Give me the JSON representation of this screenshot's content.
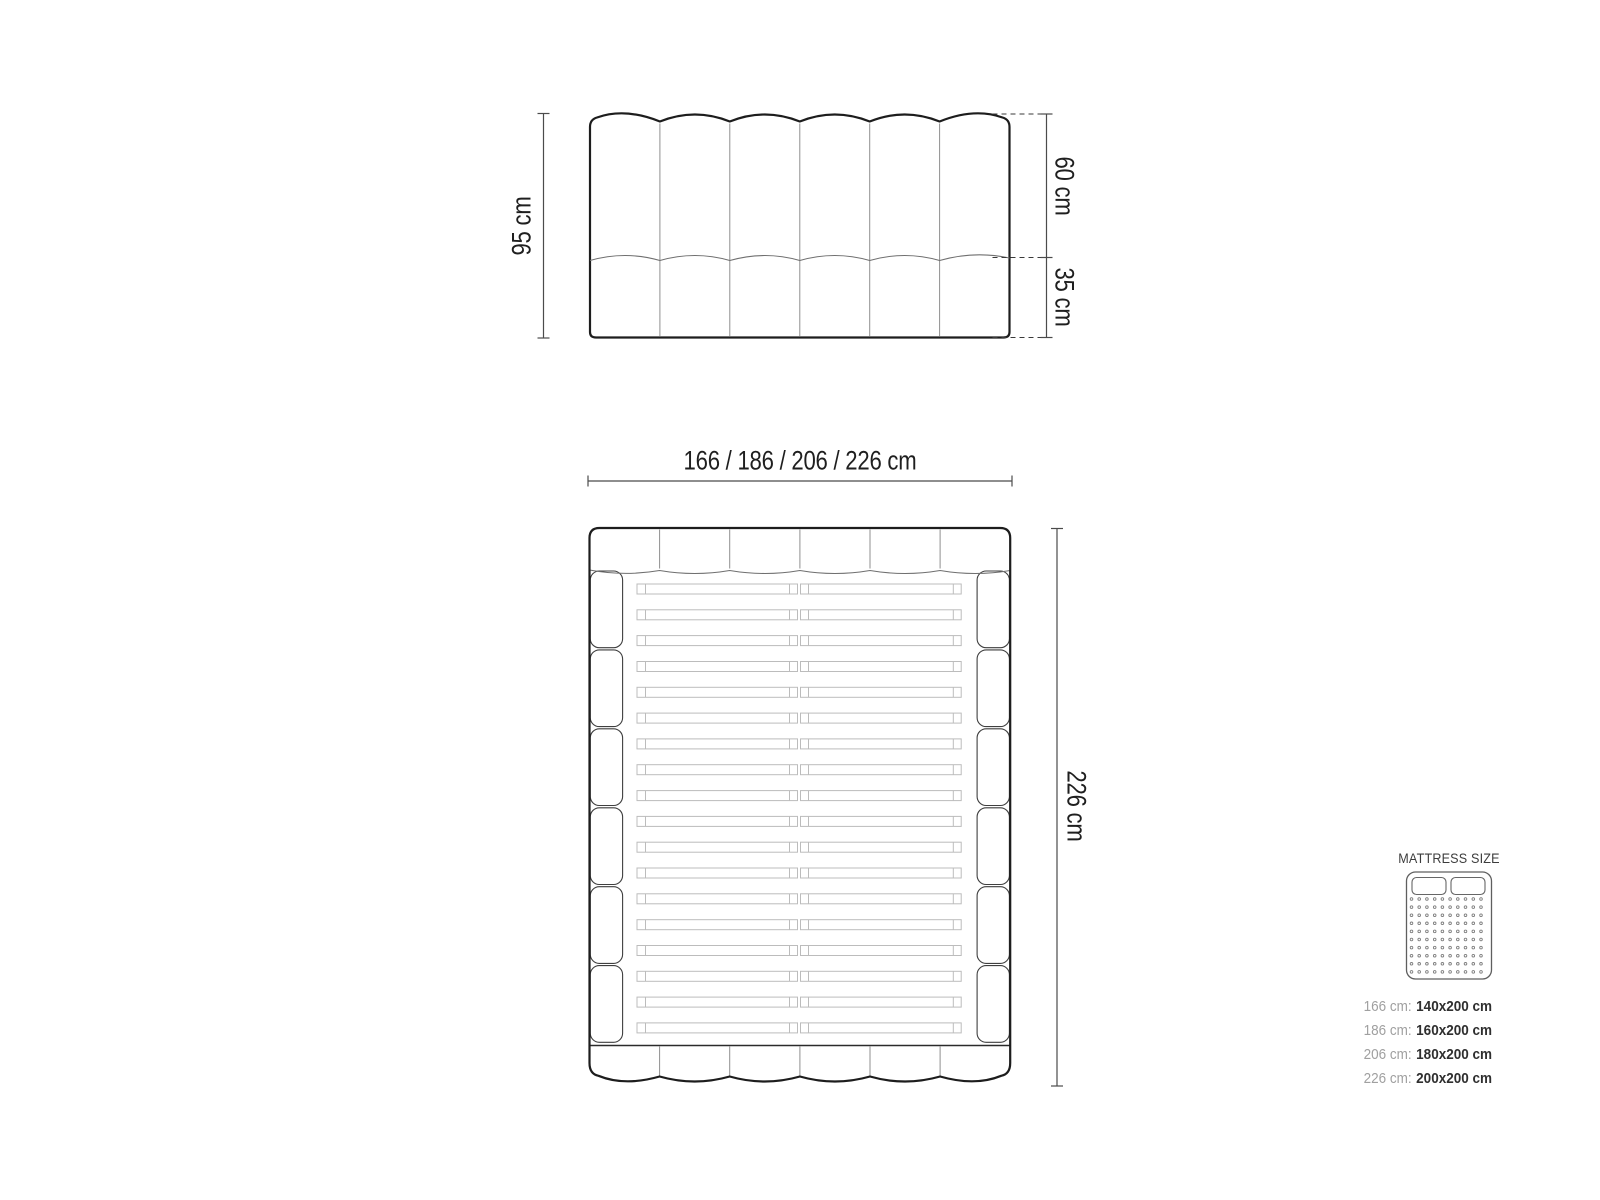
{
  "diagram": {
    "headboard_front": {
      "height_label": "95 cm",
      "upper_height_label": "60 cm",
      "lower_height_label": "35 cm",
      "channels": 6
    },
    "bed_top": {
      "width_label": "166 / 186 / 206 / 226 cm",
      "length_label": "226 cm",
      "slat_rows": 18,
      "headboard_segments": 6,
      "footboard_segments": 6,
      "rail_segments_per_side": 6
    }
  },
  "legend": {
    "title": "MATTRESS SIZE",
    "icon": "mattress-top-view-icon",
    "rows": [
      {
        "label": "166 cm:",
        "value": "140x200 cm"
      },
      {
        "label": "186 cm:",
        "value": "160x200 cm"
      },
      {
        "label": "206 cm:",
        "value": "180x200 cm"
      },
      {
        "label": "226 cm:",
        "value": "200x200 cm"
      }
    ]
  },
  "colors": {
    "background": "#ffffff",
    "outline": "#1d1d1d",
    "thin_line": "#8f8f8f",
    "tuft_line": "#6f6f6f",
    "rail_line": "#3f3f3f",
    "slat_line": "#bcbcbc",
    "dimension_line": "#4b4b4b",
    "dashed_line": "#3a3a3a",
    "label_text": "#1f1f1f",
    "legend_title": "#3c3c3c",
    "legend_label": "#a0a0a0",
    "legend_value": "#2f2f2f",
    "legend_icon_line": "#5f5f5f"
  }
}
